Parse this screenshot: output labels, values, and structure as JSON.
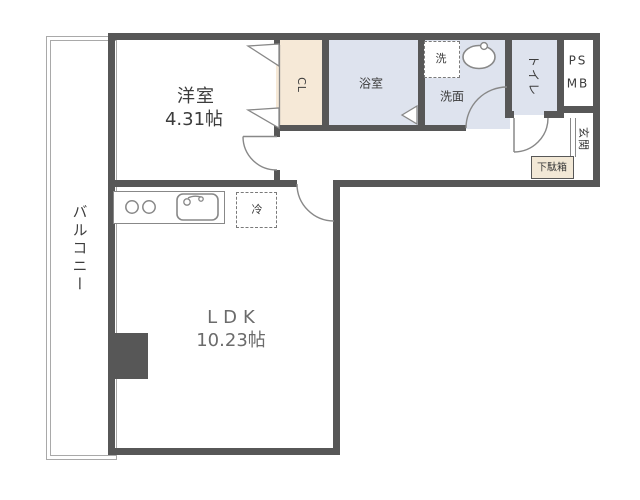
{
  "plan": {
    "rooms": {
      "western": {
        "name": "洋室",
        "size": "4.31帖"
      },
      "ldk": {
        "name": "LDK",
        "size": "10.23帖"
      },
      "balcony": {
        "name": "バルコニー"
      },
      "bathroom": {
        "name": "浴室"
      },
      "washer": {
        "name": "洗"
      },
      "washroom": {
        "name": "洗面"
      },
      "toilet": {
        "name": "トイレ"
      },
      "ps_mb": {
        "line1": "PS",
        "line2": "MB"
      },
      "entrance": {
        "name": "玄関"
      },
      "shoe_cabinet": {
        "name": "下駄箱"
      },
      "closet": {
        "name": "CL"
      },
      "fridge": {
        "name": "冷"
      }
    },
    "colors": {
      "wall": "#575757",
      "wet_area_fill": "#dee3ee",
      "closet_fill": "#f6e9d7",
      "shoe_cabinet_fill": "#f2e8d6",
      "line": "#888888",
      "text": "#3c3c3c",
      "ldk_text": "#6b6b6b"
    }
  }
}
